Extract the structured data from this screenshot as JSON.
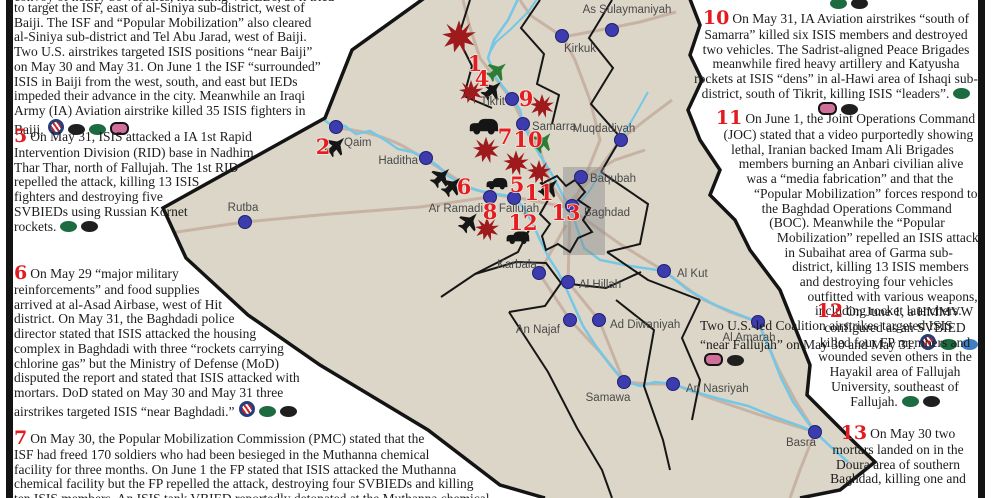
{
  "report": {
    "partial_top_left": "convoy of nearly 50 vehicles, including VBIEDs, as it tried",
    "blocks": [
      {
        "id": "b1",
        "num": "",
        "text": "to target the ISF, east of al-Siniya sub-district, west of Baiji. The ISF and “Popular Mobilization” also cleared al-Siniya sub-district and Tel Abu Jarad, west of Baiji. Two U.S. airstrikes targeted ISIS positions “near Baiji” on May 30 and May 31. On June 1 the ISF “surrounded” ISIS in Baiji from the west, south, and east but IEDs impeded their advance in the city. Meanwhile an Iraqi Army (IA) Aviation airstrike killed 35 ISIS fighters in Baiji.",
        "icons": [
          "us",
          "black",
          "green",
          "pink"
        ]
      },
      {
        "id": "b5",
        "num": "5",
        "text": "On May 31, ISIS attacked a IA 1st Rapid Intervention Division (RID) base in Nadhim Thar Thar, north of Fallujah. The 1st RID repelled the attack, killing 13 ISIS fighters and destroying five SVBIEDs using Russian Kornet rockets.",
        "icons": [
          "green",
          "black"
        ]
      },
      {
        "id": "b6",
        "num": "6",
        "text": "On May 29 “major military reinforcements” and food supplies arrived at al-Asad Airbase, west of Hit district. On May 31, the Baghdadi police director stated that ISIS attacked the housing complex in Baghdadi with three “rockets carrying chlorine gas” but the Ministry of Defense (MoD) disputed the report and stated that ISIS attacked with mortars. DoD stated on May 30 and May 31 three airstrikes targeted ISIS “near Baghdadi.”",
        "icons": [
          "us",
          "green",
          "black"
        ]
      },
      {
        "id": "b7",
        "num": "7",
        "text": "On May 30, the Popular Mobilization Commission (PMC) stated that the ISF had freed 170 soldiers who had been besieged in the Muthanna chemical facility for three months.  On June 1 the FP stated that ISIS attacked the Muthanna chemical facility but the FP repelled the attack, destroying four SVBIEDs and killing ten ISIS members.  An ISIS tank VBIED reportedly detonated at the Muthanna chemical facility",
        "icons": []
      },
      {
        "id": "b10",
        "num": "10",
        "text": "On May 31,  IA Aviation airstrikes “south of Samarra” killed six ISIS members and destroyed two vehicles. The Sadrist-aligned Peace Brigades meanwhile fired heavy artillery and Katyusha rockets at ISIS “dens” in al-Hawi area of Ishaqi sub-district, south of Tikrit, killing ISIS “leaders”.",
        "icons": [
          "green",
          "pink",
          "black"
        ]
      },
      {
        "id": "b11",
        "num": "11",
        "text": "On June 1, the Joint Operations Command (JOC) stated that a video purportedly showing lethal, Iranian backed Imam Ali Brigades members burning an Anbari civilian alive was a “media fabrication” and that the “Popular Mobilization” forces respond to the Baghdad Operations Command (BOC). Meanwhile the “Popular Mobilization” repelled an ISIS attack in Subaihat area of Garma sub-district, killing 13 ISIS members and destroying four vehicles outfitted with various weapons, including rocket launchers. Two U.S.-led Coalition airstrikes targeted ISIS “near Fallujah” on May 30 and May 31.",
        "icons": [
          "us",
          "green",
          "blue",
          "pink",
          "black"
        ]
      },
      {
        "id": "b12",
        "num": "12",
        "text": "On June 1, a HMMVW configured as an SVBIED killed four FP members and wounded seven others in the Hayakil area of Fallujah University, southeast of Fallujah.",
        "icons": [
          "green",
          "black"
        ]
      },
      {
        "id": "b13",
        "num": "13",
        "text": "On May 30 two mortars landed on in the Doura area of southern Baghdad, killing one and",
        "icons": []
      }
    ],
    "partial_top_right_icons": [
      "green",
      "black"
    ]
  },
  "legend_colors": {
    "green": "#1d6b40",
    "black": "#1f1f1f",
    "pink": "#d06f9a",
    "blue": "#3f7fc1",
    "us_ring": "#23407c",
    "us_stripe": "#cc2229",
    "event_number_red": "#e41d22",
    "map_land": "#dbd6c8",
    "river_blue": "#74c7e6",
    "road_tan": "#c7b1a2",
    "city_dot": "#3c3cae"
  },
  "map": {
    "cities": [
      {
        "name": "Qaim",
        "x": 336,
        "y": 127,
        "lx": 344,
        "ly": 146,
        "anchor": "start"
      },
      {
        "name": "Haditha",
        "x": 426,
        "y": 158,
        "lx": 418,
        "ly": 164,
        "anchor": "end"
      },
      {
        "name": "Rutba",
        "x": 245,
        "y": 222,
        "lx": 243,
        "ly": 211,
        "anchor": "middle"
      },
      {
        "name": "Ar Ramadi",
        "x": 490,
        "y": 197,
        "lx": 483,
        "ly": 212,
        "anchor": "end"
      },
      {
        "name": "Fallujah",
        "x": 514,
        "y": 198,
        "lx": 519,
        "ly": 212,
        "anchor": "middle"
      },
      {
        "name": "Baghdad",
        "x": 572,
        "y": 206,
        "lx": 584,
        "ly": 216,
        "anchor": "start"
      },
      {
        "name": "Baqubah",
        "x": 581,
        "y": 177,
        "lx": 590,
        "ly": 182,
        "anchor": "start"
      },
      {
        "name": "Muqdadiyah",
        "x": 621,
        "y": 140,
        "lx": 604,
        "ly": 132,
        "anchor": "middle"
      },
      {
        "name": "Tikrit",
        "x": 512,
        "y": 99,
        "lx": 505,
        "ly": 105,
        "anchor": "end"
      },
      {
        "name": "Samarra",
        "x": 523,
        "y": 124,
        "lx": 532,
        "ly": 130,
        "anchor": "start"
      },
      {
        "name": "Kirkuk",
        "x": 562,
        "y": 36,
        "lx": 580,
        "ly": 52,
        "anchor": "middle"
      },
      {
        "name": "As Sulaymaniyah",
        "x": 612,
        "y": 30,
        "lx": 627,
        "ly": 13,
        "anchor": "middle"
      },
      {
        "name": "Karbala",
        "x": 539,
        "y": 273,
        "lx": 517,
        "ly": 268,
        "anchor": "middle"
      },
      {
        "name": "Al Hillah",
        "x": 568,
        "y": 282,
        "lx": 579,
        "ly": 288,
        "anchor": "start"
      },
      {
        "name": "An Najaf",
        "x": 570,
        "y": 320,
        "lx": 560,
        "ly": 333,
        "anchor": "end"
      },
      {
        "name": "Ad Diwaniyah",
        "x": 599,
        "y": 320,
        "lx": 610,
        "ly": 328,
        "anchor": "start"
      },
      {
        "name": "Al Kut",
        "x": 664,
        "y": 271,
        "lx": 677,
        "ly": 277,
        "anchor": "start"
      },
      {
        "name": "Samawa",
        "x": 624,
        "y": 382,
        "lx": 608,
        "ly": 401,
        "anchor": "middle"
      },
      {
        "name": "An Nasriyah",
        "x": 673,
        "y": 384,
        "lx": 686,
        "ly": 392,
        "anchor": "start"
      },
      {
        "name": "Al Amarah",
        "x": 758,
        "y": 322,
        "lx": 749,
        "ly": 341,
        "anchor": "middle"
      },
      {
        "name": "Basra",
        "x": 815,
        "y": 432,
        "lx": 801,
        "ly": 446,
        "anchor": "middle"
      }
    ],
    "numbers": [
      {
        "n": "1",
        "x": 475,
        "y": 71
      },
      {
        "n": "2",
        "x": 323,
        "y": 154
      },
      {
        "n": "4",
        "x": 482,
        "y": 86
      },
      {
        "n": "5",
        "x": 517,
        "y": 192
      },
      {
        "n": "6",
        "x": 464,
        "y": 194
      },
      {
        "n": "7",
        "x": 505,
        "y": 144
      },
      {
        "n": "8",
        "x": 490,
        "y": 219
      },
      {
        "n": "9",
        "x": 526,
        "y": 106
      },
      {
        "n": "10",
        "x": 528,
        "y": 147
      },
      {
        "n": "11",
        "x": 539,
        "y": 200
      },
      {
        "n": "12",
        "x": 523,
        "y": 230
      },
      {
        "n": "13",
        "x": 566,
        "y": 220
      }
    ],
    "bursts": [
      {
        "x": 459,
        "y": 37,
        "s": 1.4
      },
      {
        "x": 471,
        "y": 92,
        "s": 1.0
      },
      {
        "x": 542,
        "y": 106,
        "s": 1.0
      },
      {
        "x": 486,
        "y": 150,
        "s": 1.1
      },
      {
        "x": 516,
        "y": 163,
        "s": 1.05
      },
      {
        "x": 539,
        "y": 172,
        "s": 1.0
      },
      {
        "x": 487,
        "y": 229,
        "s": 1.0
      }
    ],
    "jets": [
      {
        "x": 497,
        "y": 71,
        "c": "#2e7d36",
        "r": 50
      },
      {
        "x": 492,
        "y": 90,
        "c": "#161616",
        "r": 48
      },
      {
        "x": 543,
        "y": 142,
        "c": "#2e7d36",
        "r": 40
      },
      {
        "x": 336,
        "y": 146,
        "c": "#161616",
        "r": 45
      },
      {
        "x": 441,
        "y": 177,
        "c": "#161616",
        "r": 45
      },
      {
        "x": 452,
        "y": 186,
        "c": "#161616",
        "r": 45
      },
      {
        "x": 469,
        "y": 222,
        "c": "#161616",
        "r": 42
      },
      {
        "x": 549,
        "y": 188,
        "c": "#161616",
        "r": 45
      }
    ],
    "vehicles": [
      {
        "x": 484,
        "y": 127,
        "s": 1.5
      },
      {
        "x": 497,
        "y": 184,
        "s": 1.1
      },
      {
        "x": 518,
        "y": 238,
        "s": 1.2
      }
    ]
  }
}
